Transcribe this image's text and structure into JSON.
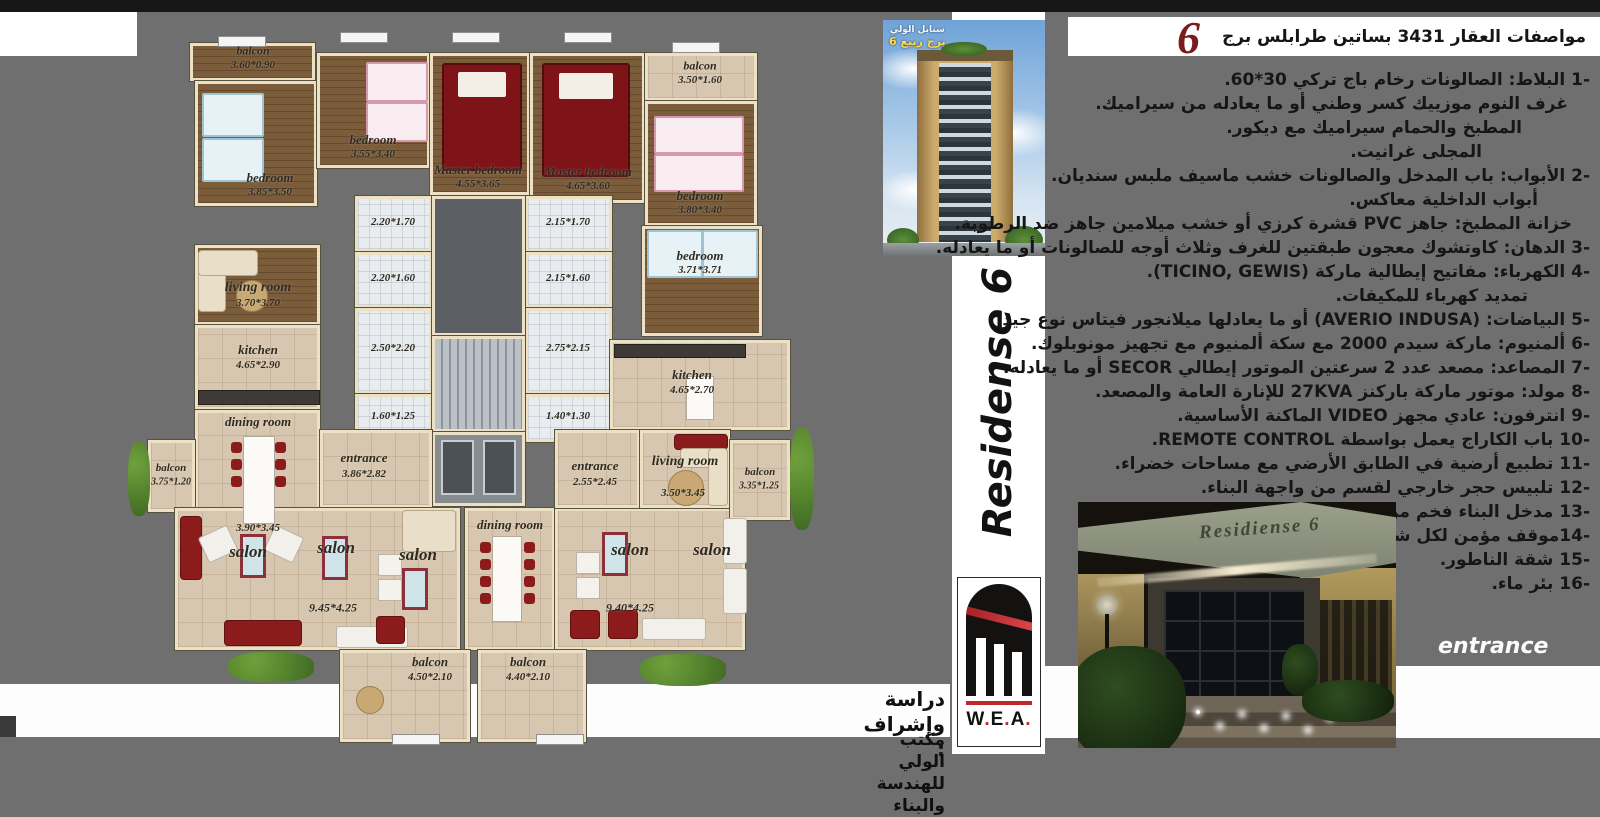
{
  "header": {
    "title": "مواصفات العقار 3431 بساتين طرابلس برج",
    "num": "6"
  },
  "specs": {
    "items": [
      {
        "t": "-1 البلاط: الصالونات رخام باج تركي 30*60.",
        "ind": 0
      },
      {
        "t": "غرف النوم موزييك كسر وطني أو ما يعادله من سيراميك.",
        "ind": 22
      },
      {
        "t": "المطبخ والحمام سيراميك مع ديكور.",
        "ind": 68
      },
      {
        "t": "المجلى غرانيت.",
        "ind": 108
      },
      {
        "t": "-2 الأبواب: باب المدخل والصالونات خشب ماسيف ملبس سنديان.",
        "ind": 0
      },
      {
        "t": "أبواب الداخلية معاكس.",
        "ind": 52
      },
      {
        "t": "خزانة المطبخ: جاهز PVC قشرة كرزي أو خشب ميلامين جاهز ضد الرطوبة.",
        "ind": 18
      },
      {
        "t": "-3 الدهان: كاوتشوك معجون طبقتين للغرف وثلاث أوجه للصالونات أو ما يعادله.",
        "ind": 0
      },
      {
        "t": "-4 الكهرباء: مفاتيح إيطالية ماركة (TICINO, GEWIS).",
        "ind": 0
      },
      {
        "t": "تمديد كهرباء للمكيفات.",
        "ind": 62
      },
      {
        "t": "-5 البياضات: (AVERIO INDUSA) أو ما يعادلها ميلانجور فيتاس نوع جيد",
        "ind": 0
      },
      {
        "t": "-6 ألمنيوم: ماركة سيدم 2000 مع سكة ألمنيوم مع تجهيز مونوبلوك.",
        "ind": 0
      },
      {
        "t": "-7 المصاعد: مصعد عدد 2 سرعتين الموتور إيطالي SECOR أو ما يعادله.",
        "ind": 0
      },
      {
        "t": "-8 مولد: موتور ماركة باركنز 27KVA للإنارة العامة والمصعد.",
        "ind": 0
      },
      {
        "t": "-9 انترفون: عادي مجهز VIDEO الماكنة الأساسية.",
        "ind": 0
      },
      {
        "t": "-10 باب الكاراج يعمل بواسطة REMOTE CONTROL.",
        "ind": 0
      },
      {
        "t": "-11 تطبيع أرضية في الطابق الأرضي مع مساحات خضراء.",
        "ind": 0
      },
      {
        "t": "-12 تلبيس حجر خارجي لقسم من واجهة البناء.",
        "ind": 0
      },
      {
        "t": "-13 مدخل البناء فخم من الرخام الإيطالي.",
        "ind": 0
      },
      {
        "t": "-14موقف مؤمن لكل شقة.",
        "ind": 0
      },
      {
        "t": "-15 شقة الناطور.",
        "ind": 0
      },
      {
        "t": "-16 بئر ماء.",
        "ind": 0
      }
    ]
  },
  "tower": {
    "line1": "سنابل الولي",
    "line2": "برج ربيع 6"
  },
  "brand": {
    "vertical": "Residense 6"
  },
  "logo": {
    "text": "W.E.A."
  },
  "credits": {
    "line1": "دراسة وإشراف :",
    "line2": "مكتب الولي للهندسة والبناء"
  },
  "photo": {
    "sign": "Residiense 6",
    "caption": "entrance"
  },
  "plan": {
    "rooms": [
      [
        50,
        5,
        125,
        38,
        "wood"
      ],
      [
        55,
        43,
        122,
        125,
        "wood"
      ],
      [
        177,
        15,
        113,
        115,
        "wood"
      ],
      [
        290,
        15,
        100,
        142,
        "wood"
      ],
      [
        390,
        15,
        115,
        150,
        "wood"
      ],
      [
        505,
        15,
        112,
        48,
        "tile"
      ],
      [
        505,
        63,
        112,
        125,
        "wood"
      ],
      [
        502,
        188,
        120,
        110,
        "wood"
      ],
      [
        215,
        158,
        77,
        56,
        "bath"
      ],
      [
        215,
        214,
        77,
        56,
        "bath"
      ],
      [
        215,
        270,
        77,
        86,
        "bath"
      ],
      [
        215,
        356,
        77,
        48,
        "bath"
      ],
      [
        385,
        158,
        87,
        56,
        "bath"
      ],
      [
        385,
        214,
        87,
        56,
        "bath"
      ],
      [
        385,
        270,
        87,
        86,
        "bath"
      ],
      [
        385,
        356,
        87,
        48,
        "bath"
      ],
      [
        292,
        158,
        93,
        140,
        "void"
      ],
      [
        292,
        298,
        93,
        96,
        "stairs"
      ],
      [
        292,
        394,
        93,
        74,
        "lift"
      ],
      [
        55,
        207,
        125,
        80,
        "wood"
      ],
      [
        55,
        287,
        125,
        85,
        "tile"
      ],
      [
        55,
        372,
        125,
        125,
        "tile"
      ],
      [
        8,
        402,
        47,
        72,
        "tile"
      ],
      [
        180,
        392,
        112,
        78,
        "tile"
      ],
      [
        35,
        470,
        285,
        142,
        "tile"
      ],
      [
        325,
        470,
        90,
        142,
        "tile"
      ],
      [
        415,
        470,
        190,
        142,
        "tile"
      ],
      [
        200,
        612,
        130,
        92,
        "tile"
      ],
      [
        338,
        612,
        108,
        92,
        "tile"
      ],
      [
        470,
        302,
        180,
        90,
        "tile"
      ],
      [
        415,
        392,
        85,
        78,
        "tile"
      ],
      [
        500,
        392,
        90,
        78,
        "tile"
      ],
      [
        590,
        402,
        60,
        80,
        "tile"
      ]
    ],
    "labels": [
      [
        "balcon",
        113,
        13,
        12
      ],
      [
        "3.60*0.90",
        113,
        27,
        11
      ],
      [
        "bedroom",
        130,
        140,
        13
      ],
      [
        "3.85*3.50",
        130,
        154,
        11
      ],
      [
        "bedroom",
        233,
        102,
        13
      ],
      [
        "3.55*3.40",
        233,
        116,
        11
      ],
      [
        "Master bedroom",
        338,
        132,
        13
      ],
      [
        "4.55*3.65",
        338,
        146,
        11
      ],
      [
        "Master bedroom",
        448,
        134,
        13
      ],
      [
        "4.65*3.60",
        448,
        148,
        11
      ],
      [
        "balcon",
        560,
        28,
        12
      ],
      [
        "3.50*1.60",
        560,
        42,
        11
      ],
      [
        "bedroom",
        560,
        158,
        13
      ],
      [
        "3.80*3.40",
        560,
        172,
        11
      ],
      [
        "bedroom",
        560,
        218,
        13
      ],
      [
        "3.71*3.71",
        560,
        232,
        11
      ],
      [
        "2.20*1.70",
        253,
        184,
        11
      ],
      [
        "2.20*1.60",
        253,
        240,
        11
      ],
      [
        "2.50*2.20",
        253,
        310,
        11
      ],
      [
        "1.60*1.25",
        253,
        378,
        11
      ],
      [
        "2.15*1.70",
        428,
        184,
        11
      ],
      [
        "2.15*1.60",
        428,
        240,
        11
      ],
      [
        "2.75*2.15",
        428,
        310,
        11
      ],
      [
        "1.40*1.30",
        428,
        378,
        11
      ],
      [
        "living room",
        118,
        250,
        14
      ],
      [
        "3.70*3.70",
        118,
        265,
        11
      ],
      [
        "kitchen",
        118,
        312,
        13
      ],
      [
        "4.65*2.90",
        118,
        327,
        11
      ],
      [
        "dining room",
        118,
        384,
        13
      ],
      [
        "3.90*3.45",
        118,
        490,
        11
      ],
      [
        "balcon",
        31,
        430,
        11
      ],
      [
        "3.75*1.20",
        31,
        444,
        10
      ],
      [
        "entrance",
        224,
        420,
        13
      ],
      [
        "3.86*2.82",
        224,
        436,
        11
      ],
      [
        "salon",
        108,
        514,
        17
      ],
      [
        "salon",
        196,
        510,
        17
      ],
      [
        "salon",
        278,
        517,
        17
      ],
      [
        "9.45*4.25",
        193,
        570,
        12
      ],
      [
        "dining room",
        370,
        487,
        13
      ],
      [
        "kitchen",
        552,
        337,
        13
      ],
      [
        "4.65*2.70",
        552,
        352,
        11
      ],
      [
        "entrance",
        455,
        428,
        13
      ],
      [
        "2.55*2.45",
        455,
        444,
        11
      ],
      [
        "living room",
        545,
        424,
        14
      ],
      [
        "3.50*3.45",
        543,
        455,
        11
      ],
      [
        "balcon",
        620,
        434,
        11
      ],
      [
        "3.35*1.25",
        619,
        448,
        10
      ],
      [
        "salon",
        490,
        512,
        17
      ],
      [
        "salon",
        572,
        512,
        17
      ],
      [
        "9.40*4.25",
        490,
        570,
        12
      ],
      [
        "balcon",
        290,
        624,
        13
      ],
      [
        "4.50*2.10",
        290,
        639,
        11
      ],
      [
        "balcon",
        388,
        624,
        13
      ],
      [
        "4.40*2.10",
        388,
        639,
        11
      ]
    ],
    "furniture": [
      [
        "bedred",
        302,
        25,
        76,
        104,
        0
      ],
      [
        "bedred",
        402,
        25,
        84,
        110,
        0
      ],
      [
        "bedkid blue",
        62,
        55,
        58,
        40,
        0
      ],
      [
        "bedkid blue",
        62,
        100,
        58,
        40,
        0
      ],
      [
        "bedkid pink",
        226,
        24,
        58,
        36,
        0
      ],
      [
        "bedkid pink",
        226,
        64,
        58,
        36,
        0
      ],
      [
        "bedkid pink",
        514,
        78,
        86,
        34,
        0
      ],
      [
        "bedkid pink",
        514,
        116,
        86,
        34,
        0
      ],
      [
        "bedkid blue",
        507,
        192,
        52,
        44,
        0
      ],
      [
        "bedkid blue",
        562,
        192,
        52,
        44,
        0
      ],
      [
        "sofac",
        58,
        212,
        26,
        60,
        0
      ],
      [
        "sofac",
        58,
        212,
        58,
        24,
        0
      ],
      [
        "rug",
        96,
        242,
        30,
        30,
        0
      ],
      [
        "counter",
        58,
        352,
        120,
        13,
        0
      ],
      [
        "tablew",
        103,
        398,
        30,
        86,
        0
      ],
      [
        "chairr",
        91,
        404,
        11,
        11,
        0
      ],
      [
        "chairr",
        91,
        421,
        11,
        11,
        0
      ],
      [
        "chairr",
        91,
        438,
        11,
        11,
        0
      ],
      [
        "chairr",
        135,
        404,
        11,
        11,
        0
      ],
      [
        "chairr",
        135,
        421,
        11,
        11,
        0
      ],
      [
        "chairr",
        135,
        438,
        11,
        11,
        0
      ],
      [
        "sofar",
        40,
        478,
        20,
        62,
        0
      ],
      [
        "sofaw",
        62,
        492,
        30,
        26,
        -25
      ],
      [
        "sofaw",
        128,
        492,
        30,
        26,
        25
      ],
      [
        "mirror",
        100,
        496,
        26,
        44,
        0
      ],
      [
        "mirror",
        182,
        498,
        26,
        44,
        0
      ],
      [
        "mirror",
        262,
        530,
        26,
        42,
        0
      ],
      [
        "white2",
        238,
        516,
        22,
        20,
        0
      ],
      [
        "white2",
        238,
        541,
        22,
        20,
        0
      ],
      [
        "sofar",
        84,
        582,
        76,
        24,
        0
      ],
      [
        "sofaw",
        196,
        588,
        70,
        20,
        0
      ],
      [
        "sofar",
        236,
        578,
        27,
        26,
        0
      ],
      [
        "sofac",
        262,
        472,
        52,
        40,
        0
      ],
      [
        "tablew",
        352,
        498,
        28,
        84,
        0
      ],
      [
        "chairr",
        340,
        504,
        11,
        11,
        0
      ],
      [
        "chairr",
        340,
        521,
        11,
        11,
        0
      ],
      [
        "chairr",
        340,
        538,
        11,
        11,
        0
      ],
      [
        "chairr",
        340,
        555,
        11,
        11,
        0
      ],
      [
        "chairr",
        384,
        504,
        11,
        11,
        0
      ],
      [
        "chairr",
        384,
        521,
        11,
        11,
        0
      ],
      [
        "chairr",
        384,
        538,
        11,
        11,
        0
      ],
      [
        "chairr",
        384,
        555,
        11,
        11,
        0
      ],
      [
        "mirror",
        462,
        494,
        26,
        44,
        0
      ],
      [
        "white2",
        436,
        514,
        22,
        20,
        0
      ],
      [
        "white2",
        436,
        539,
        22,
        20,
        0
      ],
      [
        "sofaw",
        583,
        480,
        22,
        44,
        0
      ],
      [
        "sofaw",
        583,
        530,
        22,
        44,
        0
      ],
      [
        "sofar",
        430,
        572,
        28,
        27,
        0
      ],
      [
        "sofar",
        468,
        572,
        28,
        27,
        0
      ],
      [
        "sofaw",
        502,
        580,
        62,
        20,
        0
      ],
      [
        "sofar",
        534,
        396,
        52,
        14,
        0
      ],
      [
        "sofac",
        540,
        410,
        44,
        18,
        0
      ],
      [
        "sofac",
        568,
        410,
        18,
        56,
        0
      ],
      [
        "rug",
        528,
        432,
        34,
        34,
        0
      ],
      [
        "counter",
        474,
        306,
        130,
        12,
        0
      ],
      [
        "tablew",
        546,
        338,
        26,
        42,
        0
      ],
      [
        "rug",
        216,
        648,
        26,
        26,
        0
      ],
      [
        "plant",
        -12,
        404,
        22,
        74,
        0
      ],
      [
        "plant",
        88,
        614,
        86,
        30,
        0
      ],
      [
        "plant",
        500,
        616,
        86,
        32,
        0
      ],
      [
        "plant",
        650,
        390,
        24,
        102,
        0
      ],
      [
        "win",
        78,
        -2,
        46,
        9,
        0
      ],
      [
        "win",
        200,
        -6,
        46,
        9,
        0
      ],
      [
        "win",
        312,
        -6,
        46,
        9,
        0
      ],
      [
        "win",
        424,
        -6,
        46,
        9,
        0
      ],
      [
        "win",
        532,
        4,
        46,
        9,
        0
      ],
      [
        "win",
        252,
        696,
        46,
        9,
        0
      ],
      [
        "win",
        396,
        696,
        46,
        9,
        0
      ]
    ]
  }
}
